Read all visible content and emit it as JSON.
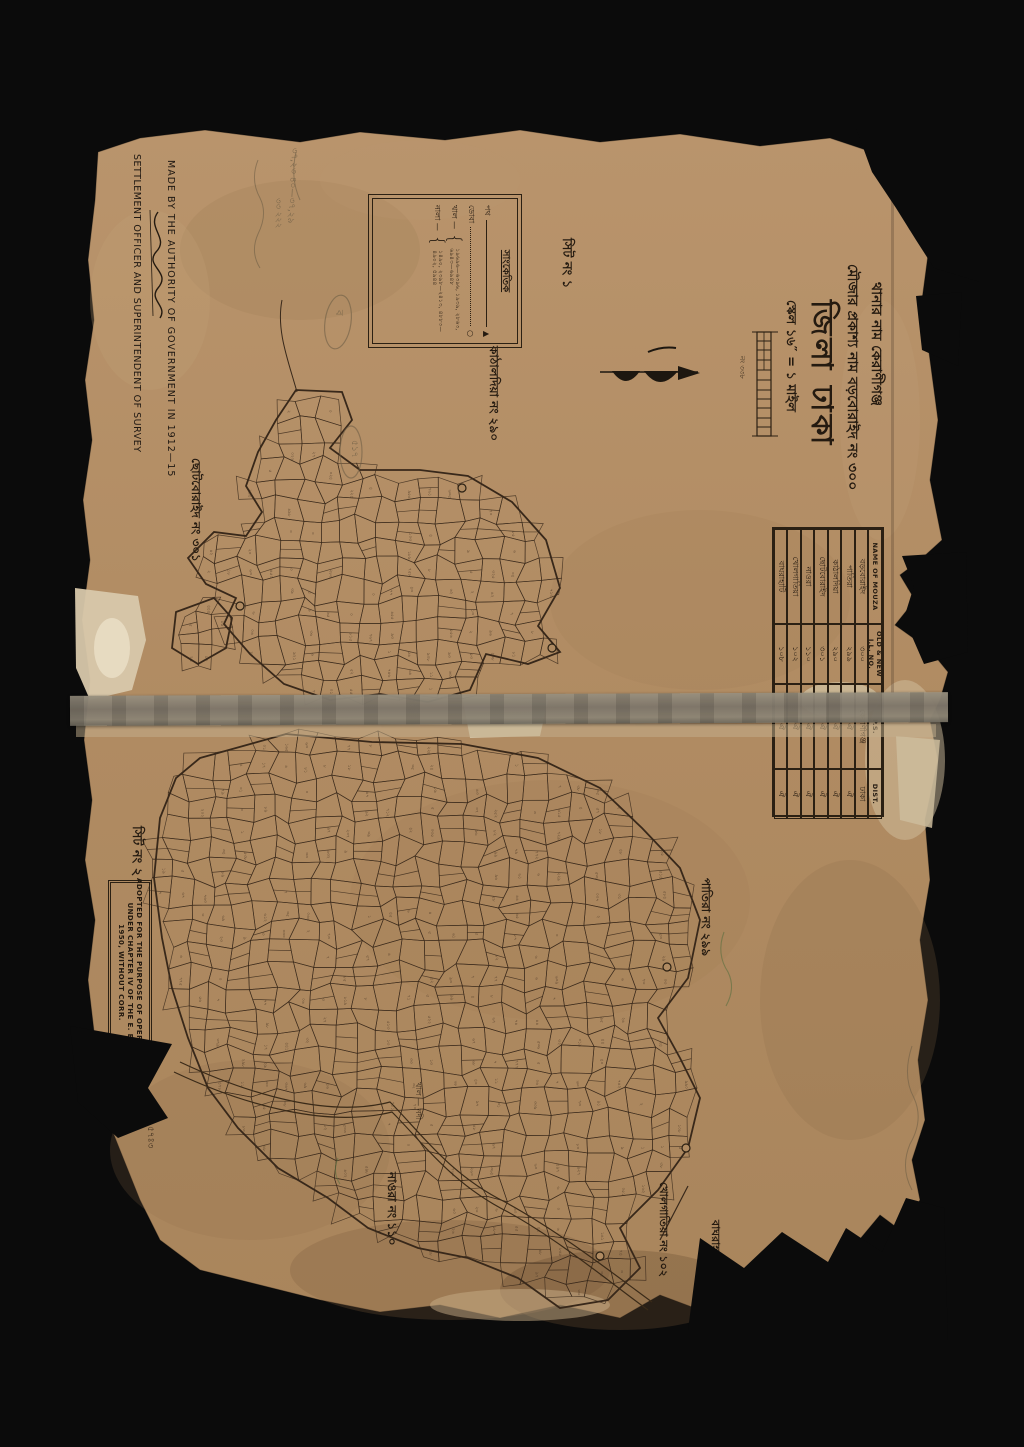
{
  "colors": {
    "background": "#0b0b0b",
    "paper": "#b08b62",
    "ink": "#2b2013",
    "pencil": "#6f5f46",
    "green_pencil": "#5f7042",
    "tape": "#7e766a"
  },
  "attribution": {
    "line1": "MADE BY THE AUTHORITY OF GOVERNMENT IN 1912—15",
    "line2": "SETTLEMENT OFFICER AND SUPERINTENDENT OF SURVEY"
  },
  "title_block": {
    "thana": "থানার নাম কেরাণীগঞ্জ",
    "mouza": "মৌজার প্রকাশ্য নাম বড়বোরাইদ নং ৩০০",
    "district": "জিলা ঢাকা",
    "scale": "স্কেল ১৬″ = ১ মাইল",
    "scale_bar_note": "নং ৩৩৮"
  },
  "legend": {
    "heading": "সাংকেতিক",
    "items": [
      {
        "label": "পথ",
        "numbers": ""
      },
      {
        "label": "ডোবা",
        "numbers": ""
      },
      {
        "label": "খাল —",
        "numbers": "১৯৬৯৬—৬৩৯৬, ১৯৩৯, ২৮৬৩, ৬৯৪৩—৬৯৪৮"
      },
      {
        "label": "নালা —",
        "numbers": "১৪৯০, ২৩৯৮—২৪১৩, ৪৮৮৩—৪৯০২, ৫৯৪৪"
      }
    ]
  },
  "sheets": {
    "sheet1": "সিট নং ১",
    "sheet2": "সিট নং ২"
  },
  "map_labels": {
    "kathaldia": "কাঠালদিয়া নং ২৯০",
    "chhotoboraid": "ছোটবোরাইদ নং ৩০১",
    "patira": "পাতিরা নং ২৯৯",
    "naora": "নাওরা নং ১১০",
    "kholgatia": "খোলগাতিয়া নং ১০২",
    "bagrahati": "বাঘরাহাটি",
    "river": "খাল — নদী"
  },
  "mouza_table": {
    "headers": [
      "NAME OF MOUZA",
      "OLD & NEW J.L. NO.",
      "P.S.",
      "DIST."
    ],
    "rows": [
      [
        "বড়বোরাইদ",
        "৩০০",
        "কেরাণীগঞ্জ",
        "ঢাকা"
      ],
      [
        "পাতিরা",
        "২৯৯",
        "ঐ",
        "ঐ"
      ],
      [
        "কাঠালদিয়া",
        "২৯০",
        "ঐ",
        "ঐ"
      ],
      [
        "ছোটবোরাইদ",
        "৩০১",
        "ঐ",
        "ঐ"
      ],
      [
        "নাওরা",
        "১১০",
        "ঐ",
        "ঐ"
      ],
      [
        "খোলগাতিয়া",
        "১০২",
        "ঐ",
        "ঐ"
      ],
      [
        "বাঘরাহাটি",
        "১০৮",
        "ঐ",
        "ঐ"
      ]
    ]
  },
  "stamp": {
    "line1": "ADOPTED FOR THE PURPOSE OF OPERATION",
    "line2": "UNDER CHAPTER IV OF THE E. B.",
    "line3": "1950, WITHOUT CORR.",
    "sub": "SETTLEMENT OFFICE"
  },
  "annotations": {
    "pencil1": "৩৭,২৩ ৪০—৩৭,২৯",
    "pencil2": "৩৩ ২২২",
    "pencil3": "৫৭ঃ৩",
    "oval1": "ব",
    "oval2": "৫১৭"
  }
}
